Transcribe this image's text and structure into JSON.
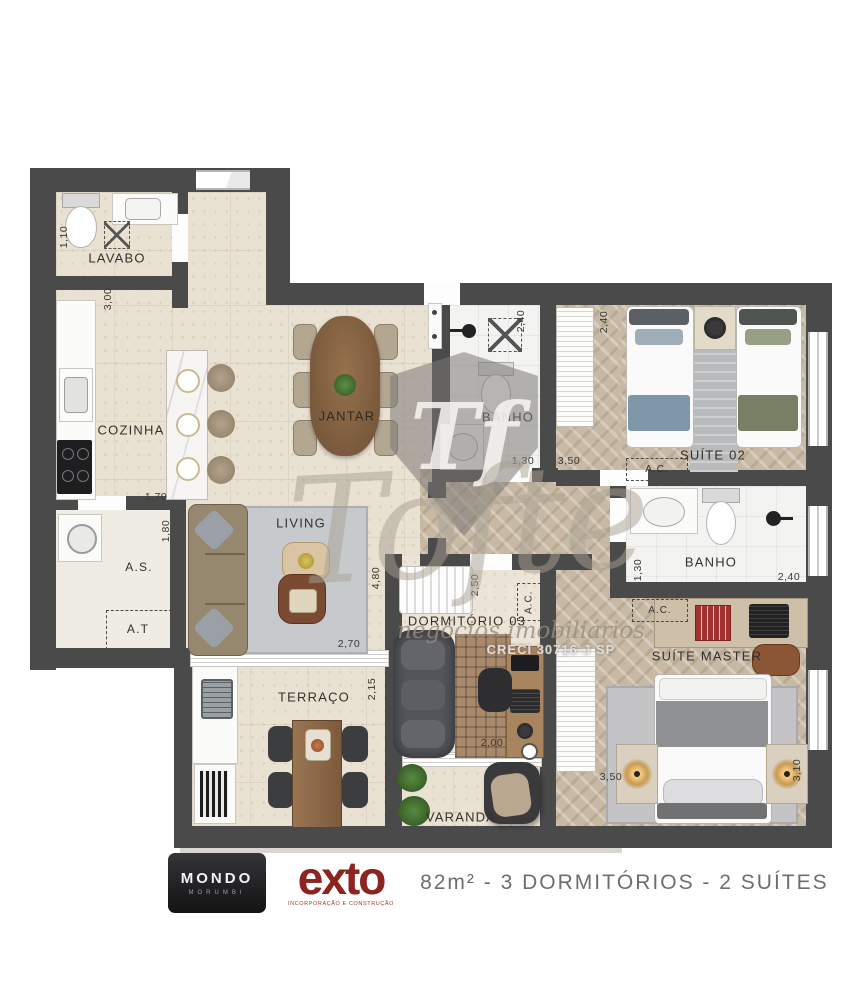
{
  "plan": {
    "title": "82m² - 3 DORMITÓRIOS - 2 SUÍTES",
    "colors": {
      "wall": "#4a4a4a",
      "floor_beige": "#e9e1d2",
      "floor_wood": "#c8b9a4",
      "floor_bath": "#f3f3f1",
      "exto_red": "#8e2420",
      "mondo_blue": "#4a9fd8"
    }
  },
  "rooms": {
    "lavabo": "LAVABO",
    "cozinha": "COZINHA",
    "jantar": "JANTAR",
    "banho": "BANHO",
    "suite02": "SUÍTE 02",
    "as": "A.S.",
    "at": "A.T",
    "living": "LIVING",
    "dormitorio03": "DORMITÓRIO 03",
    "suite_master": "SUÍTE MASTER",
    "terraco": "TERRAÇO",
    "varanda": "VARANDA",
    "ac": "A.C."
  },
  "dims": {
    "lavabo_110": "1,10",
    "nook_300": "3,00",
    "cozinha_170": "1,70",
    "cozinha_180": "1,80",
    "living_270": "2,70",
    "living_480": "4,80",
    "terraco_215": "2,15",
    "banho1_240": "2,40",
    "banho1_130": "1,30",
    "hall_350": "3,50",
    "suite02_240": "2,40",
    "dorm3_250": "2,50",
    "dorm3_200": "2,00",
    "banho2_130": "1,30",
    "banho2_240": "2,40",
    "master_350": "3,50",
    "master_310": "3,10"
  },
  "watermark": {
    "monogram": "Tf",
    "script": "Tofte",
    "tagline": "negócios imobiliários",
    "creci": "CRECI 30716-J SP"
  },
  "footer": {
    "mondo_name": "MONDO",
    "mondo_sub": "MORUMBI",
    "exto_name": "exto",
    "exto_sub": "INCORPORAÇÃO E CONSTRUÇÃO",
    "summary": "82m² - 3 DORMITÓRIOS - 2 SUÍTES"
  }
}
